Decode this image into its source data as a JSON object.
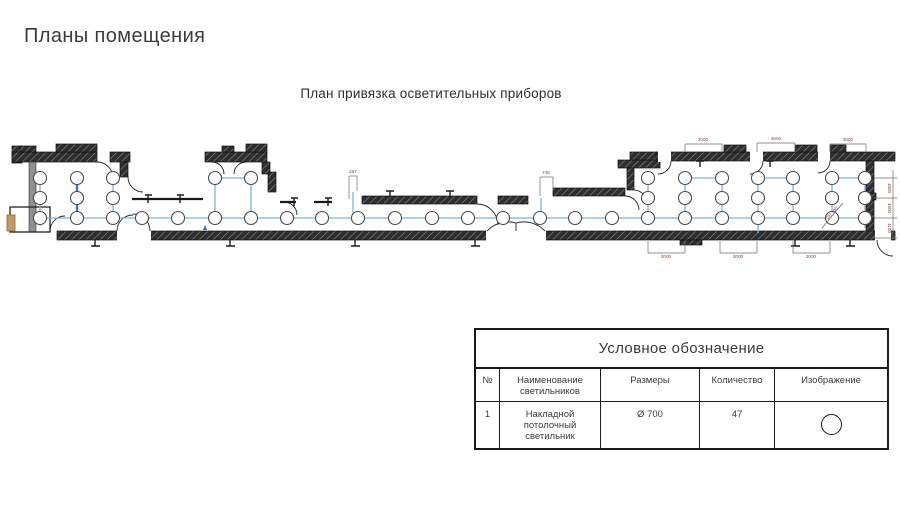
{
  "slide": {
    "title": "Планы помещения",
    "subtitle": "План привязка осветительных приборов"
  },
  "plan": {
    "fixture_radius": 6.5,
    "wire_color": "#7fb0da",
    "bold_wire_color": "#3d76bd",
    "dim_color": "#8a4a30",
    "dim_line_color": "#6b6b6b",
    "fixtures": [
      [
        40,
        218
      ],
      [
        77,
        218
      ],
      [
        113,
        218
      ],
      [
        142,
        218
      ],
      [
        178,
        218
      ],
      [
        215,
        218
      ],
      [
        251,
        218
      ],
      [
        287,
        218
      ],
      [
        322,
        218
      ],
      [
        358,
        218
      ],
      [
        395,
        218
      ],
      [
        432,
        218
      ],
      [
        468,
        218
      ],
      [
        503,
        218
      ],
      [
        540,
        218
      ],
      [
        575,
        218
      ],
      [
        612,
        218
      ],
      [
        648,
        218
      ],
      [
        685,
        218
      ],
      [
        722,
        218
      ],
      [
        758,
        218
      ],
      [
        793,
        218
      ],
      [
        832,
        218
      ],
      [
        865,
        218
      ],
      [
        40,
        198
      ],
      [
        77,
        198
      ],
      [
        113,
        198
      ],
      [
        648,
        198
      ],
      [
        685,
        198
      ],
      [
        722,
        198
      ],
      [
        758,
        198
      ],
      [
        793,
        198
      ],
      [
        832,
        198
      ],
      [
        865,
        198
      ],
      [
        40,
        178
      ],
      [
        77,
        178
      ],
      [
        113,
        178
      ],
      [
        215,
        178
      ],
      [
        251,
        178
      ],
      [
        648,
        178
      ],
      [
        685,
        178
      ],
      [
        722,
        178
      ],
      [
        758,
        178
      ],
      [
        793,
        178
      ],
      [
        832,
        178
      ],
      [
        865,
        178
      ]
    ],
    "wires": [
      [
        35,
        218,
        866,
        218
      ],
      [
        40,
        171,
        40,
        226
      ],
      [
        113,
        172,
        113,
        218
      ],
      [
        215,
        178,
        251,
        178
      ],
      [
        215,
        178,
        215,
        218
      ],
      [
        251,
        178,
        251,
        218
      ],
      [
        648,
        178,
        648,
        218
      ],
      [
        685,
        178,
        685,
        218
      ],
      [
        722,
        178,
        722,
        218
      ],
      [
        758,
        178,
        758,
        233
      ],
      [
        793,
        178,
        793,
        218
      ],
      [
        832,
        178,
        832,
        218
      ],
      [
        865,
        171,
        865,
        228
      ],
      [
        685,
        178,
        722,
        178
      ],
      [
        758,
        178,
        793,
        178
      ],
      [
        832,
        178,
        865,
        178
      ],
      [
        353,
        192,
        353,
        218
      ],
      [
        541,
        198,
        541,
        218
      ]
    ],
    "bold_wires": [
      [
        77,
        172,
        77,
        222
      ]
    ],
    "dim_lines": [
      [
        685,
        144,
        722,
        144
      ],
      [
        685,
        144,
        685,
        152
      ],
      [
        722,
        144,
        722,
        152
      ],
      [
        757,
        143,
        795,
        143
      ],
      [
        757,
        143,
        757,
        152
      ],
      [
        795,
        143,
        795,
        152
      ],
      [
        830,
        144,
        866,
        144
      ],
      [
        830,
        144,
        830,
        152
      ],
      [
        866,
        144,
        866,
        152
      ],
      [
        648,
        253,
        685,
        253
      ],
      [
        648,
        241,
        648,
        253
      ],
      [
        685,
        241,
        685,
        253
      ],
      [
        720,
        253,
        757,
        253
      ],
      [
        720,
        241,
        720,
        253
      ],
      [
        757,
        241,
        757,
        253
      ],
      [
        793,
        253,
        830,
        253
      ],
      [
        793,
        241,
        793,
        253
      ],
      [
        830,
        241,
        830,
        253
      ],
      [
        349,
        176,
        357,
        176
      ],
      [
        349,
        176,
        349,
        199
      ],
      [
        357,
        176,
        357,
        191
      ],
      [
        540,
        177,
        553,
        177
      ],
      [
        540,
        177,
        540,
        196
      ],
      [
        553,
        177,
        553,
        191
      ],
      [
        893,
        170,
        893,
        238
      ],
      [
        874,
        178,
        897,
        178
      ],
      [
        874,
        198,
        897,
        198
      ],
      [
        874,
        218,
        897,
        218
      ],
      [
        874,
        238,
        897,
        238
      ],
      [
        822,
        228,
        843,
        203
      ]
    ],
    "dim_labels": [
      {
        "text": "267",
        "x": 353,
        "y": 173,
        "rot": 0
      },
      {
        "text": "745",
        "x": 546,
        "y": 174,
        "rot": 0
      },
      {
        "text": "3000",
        "x": 703,
        "y": 141,
        "rot": 0
      },
      {
        "text": "3000",
        "x": 776,
        "y": 140,
        "rot": 0
      },
      {
        "text": "3000",
        "x": 848,
        "y": 141,
        "rot": 0
      },
      {
        "text": "3000",
        "x": 666,
        "y": 258,
        "rot": 0
      },
      {
        "text": "3000",
        "x": 738,
        "y": 258,
        "rot": 0
      },
      {
        "text": "3000",
        "x": 811,
        "y": 258,
        "rot": 0
      },
      {
        "text": "1800",
        "x": 888,
        "y": 188,
        "rot": 90
      },
      {
        "text": "1800",
        "x": 888,
        "y": 208,
        "rot": 90
      },
      {
        "text": "1100",
        "x": 888,
        "y": 228,
        "rot": 90
      },
      {
        "text": "Ø0.700",
        "x": 833,
        "y": 214,
        "rot": -48
      }
    ]
  },
  "legend": {
    "title": "Условное обозначение",
    "columns": [
      "№",
      "Наименование светильников",
      "Размеры",
      "Количество",
      "Изображение"
    ],
    "row": {
      "num": "1",
      "name": "Накладной потолочный светильник",
      "size": "Ø 700",
      "qty": "47",
      "symbol": "circle"
    }
  }
}
